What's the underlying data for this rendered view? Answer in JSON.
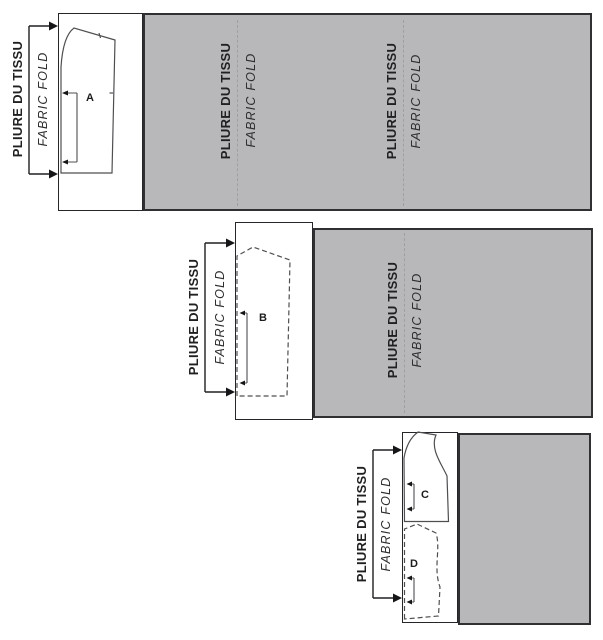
{
  "colors": {
    "fabric_fill": "#b8b8bb",
    "fabric_border": "#303033",
    "panel_fill": "#ffffff",
    "panel_border": "#26262a",
    "piece_outline": "#4f4f52",
    "fold_dash_line": "#9da0a2",
    "arrow": "#161618",
    "text": "#202023"
  },
  "diagrams": [
    {
      "name": "layout-1",
      "fold_labels": [
        {
          "fr": "PLIURE DU TISSU",
          "en": "FABRIC FOLD"
        },
        {
          "fr": "PLIURE DU TISSU",
          "en": "FABRIC FOLD"
        },
        {
          "fr": "PLIURE DU TISSU",
          "en": "FABRIC FOLD"
        }
      ],
      "pieces": [
        {
          "label": "A",
          "outline": "solid"
        }
      ]
    },
    {
      "name": "layout-2",
      "fold_labels": [
        {
          "fr": "PLIURE DU TISSU",
          "en": "FABRIC FOLD"
        },
        {
          "fr": "PLIURE DU TISSU",
          "en": "FABRIC FOLD"
        }
      ],
      "pieces": [
        {
          "label": "B",
          "outline": "dashed"
        }
      ]
    },
    {
      "name": "layout-3",
      "fold_labels": [
        {
          "fr": "PLIURE DU TISSU",
          "en": "FABRIC FOLD"
        }
      ],
      "pieces": [
        {
          "label": "C",
          "outline": "solid"
        },
        {
          "label": "D",
          "outline": "dashed"
        }
      ]
    }
  ]
}
